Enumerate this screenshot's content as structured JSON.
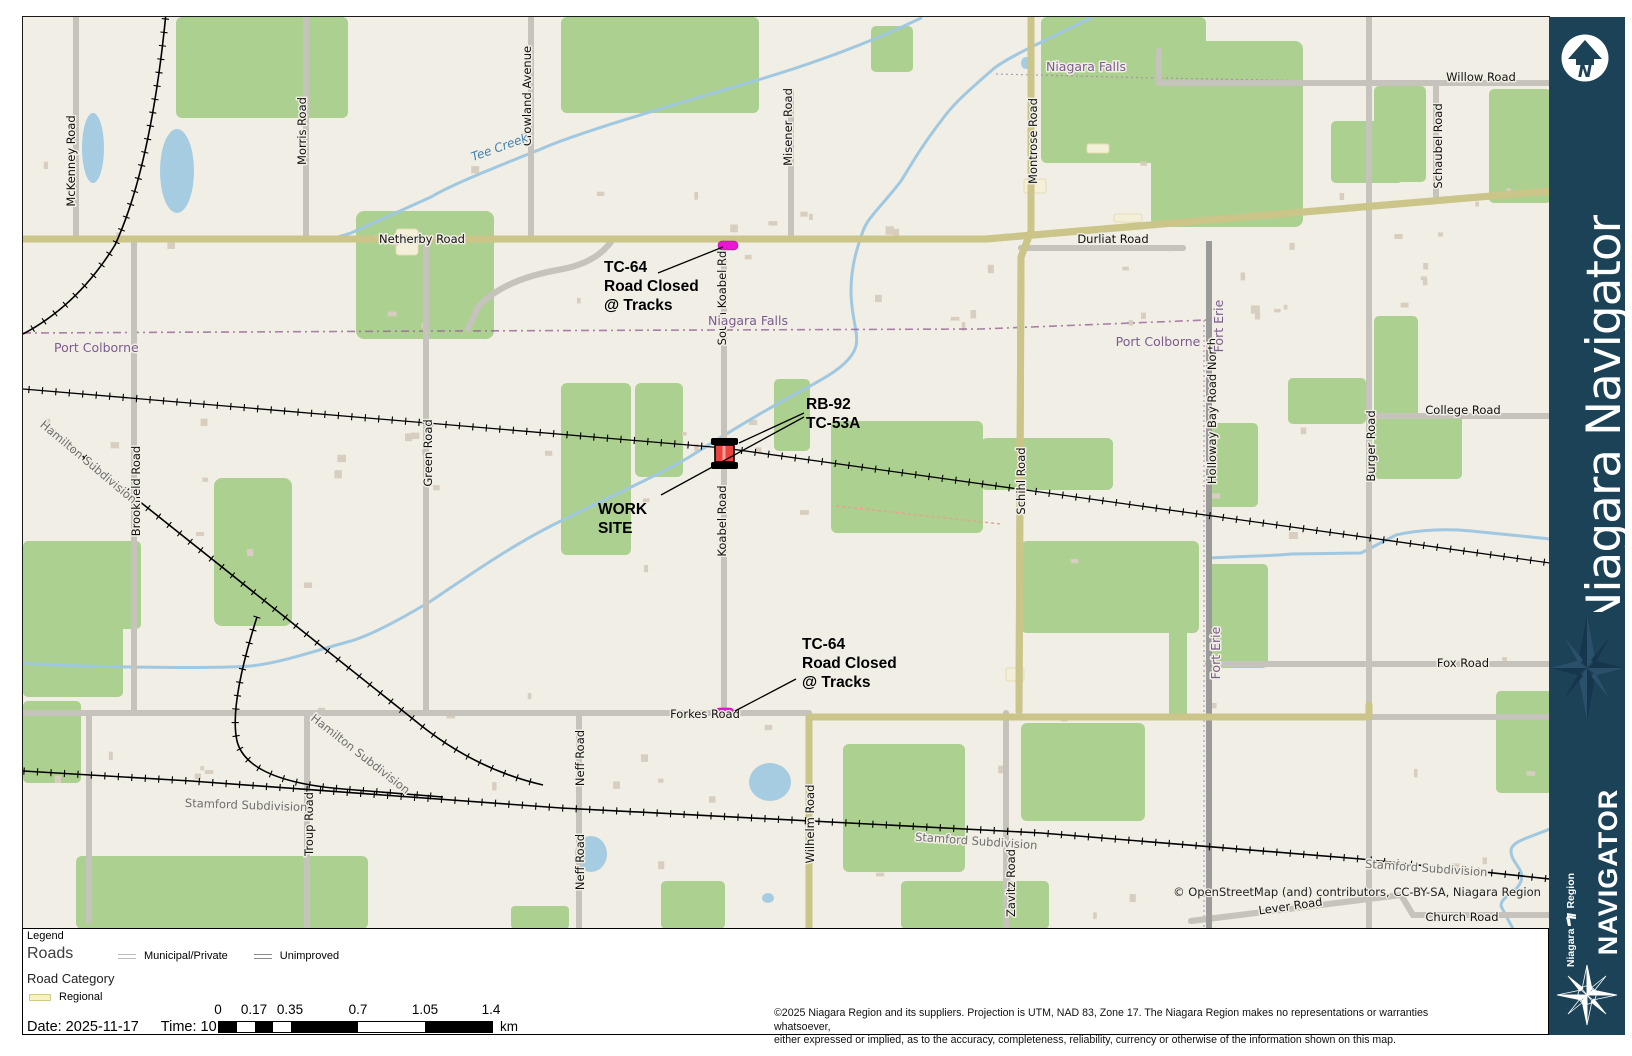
{
  "sidebar": {
    "brand": "Niagara Navigator",
    "navigator_label": "NAVIGATOR",
    "region_logo": {
      "line1": "Niagara",
      "line2": "Region"
    },
    "north_letter": "N"
  },
  "legend": {
    "title": "Legend",
    "roads_heading": "Roads",
    "road_category_heading": "Road Category",
    "road_items": [
      {
        "label": "Municipal/Private",
        "type": "municipal"
      },
      {
        "label": "Unimproved",
        "type": "unimproved"
      }
    ],
    "category_items": [
      {
        "label": "Regional",
        "type": "regional"
      }
    ],
    "date_label": "Date: 2025-11-17",
    "time_label": "Time: 10:06 AM"
  },
  "scalebar": {
    "ticks": [
      "0",
      "0.17",
      "0.35",
      "0.7",
      "1.05",
      "1.4"
    ],
    "unit": "km"
  },
  "footer": {
    "copyright_line1": "©2025 Niagara Region and its suppliers. Projection is UTM, NAD 83, Zone 17.  The Niagara Region makes no representations or warranties whatsoever,",
    "copyright_line2": "either expressed or implied, as to the accuracy, completeness, reliability, currency or otherwise of the information shown on this map."
  },
  "map": {
    "attribution": "© OpenStreetMap (and) contributors, CC-BY-SA, Niagara Region",
    "labels": [
      {
        "t": "McKenney Road",
        "x": 52,
        "y": 144,
        "r": -90,
        "c": ""
      },
      {
        "t": "Morris Road",
        "x": 283,
        "y": 114,
        "r": -90,
        "c": ""
      },
      {
        "t": "Crowland Avenue",
        "x": 508,
        "y": 79,
        "r": -90,
        "c": ""
      },
      {
        "t": "Misener Road",
        "x": 769,
        "y": 110,
        "r": -90,
        "c": ""
      },
      {
        "t": "South Koabel Rd",
        "x": 703,
        "y": 281,
        "r": -90,
        "c": ""
      },
      {
        "t": "Koabel Road",
        "x": 703,
        "y": 504,
        "r": -90,
        "c": ""
      },
      {
        "t": "Montrose Road",
        "x": 1014,
        "y": 124,
        "r": -90,
        "c": ""
      },
      {
        "t": "Schihl Road",
        "x": 1002,
        "y": 464,
        "r": -90,
        "c": ""
      },
      {
        "t": "Green Road",
        "x": 409,
        "y": 436,
        "r": -90,
        "c": ""
      },
      {
        "t": "Brookfield Road",
        "x": 117,
        "y": 474,
        "r": -90,
        "c": ""
      },
      {
        "t": "Burger Road",
        "x": 1352,
        "y": 429,
        "r": -90,
        "c": ""
      },
      {
        "t": "Holloway Bay Road North",
        "x": 1193,
        "y": 394,
        "r": -90,
        "c": ""
      },
      {
        "t": "Schaubel Road",
        "x": 1419,
        "y": 129,
        "r": -90,
        "c": ""
      },
      {
        "t": "Neff Road",
        "x": 561,
        "y": 741,
        "r": -90,
        "c": ""
      },
      {
        "t": "Neff Road",
        "x": 561,
        "y": 845,
        "r": -90,
        "c": ""
      },
      {
        "t": "Troup Road",
        "x": 290,
        "y": 807,
        "r": -90,
        "c": ""
      },
      {
        "t": "Wilhelm Road",
        "x": 791,
        "y": 807,
        "r": -90,
        "c": ""
      },
      {
        "t": "Zavitz Road",
        "x": 992,
        "y": 866,
        "r": -90,
        "c": ""
      },
      {
        "t": "Netherby Road",
        "x": 399,
        "y": 226,
        "r": 0,
        "c": ""
      },
      {
        "t": "Durliat Road",
        "x": 1090,
        "y": 226,
        "r": 0,
        "c": ""
      },
      {
        "t": "Willow Road",
        "x": 1458,
        "y": 64,
        "r": 0,
        "c": ""
      },
      {
        "t": "College Road",
        "x": 1440,
        "y": 397,
        "r": 0,
        "c": ""
      },
      {
        "t": "Fox Road",
        "x": 1440,
        "y": 650,
        "r": 0,
        "c": ""
      },
      {
        "t": "Forkes Road",
        "x": 682,
        "y": 701,
        "r": 0,
        "c": ""
      },
      {
        "t": "Lever Road",
        "x": 1268,
        "y": 893,
        "r": -8,
        "c": ""
      },
      {
        "t": "Church Road",
        "x": 1439,
        "y": 904,
        "r": 0,
        "c": ""
      },
      {
        "t": "Niagara Falls",
        "x": 1063,
        "y": 54,
        "r": 0,
        "c": "bnd"
      },
      {
        "t": "Niagara Falls",
        "x": 725,
        "y": 308,
        "r": 0,
        "c": "bnd"
      },
      {
        "t": "Port Colborne",
        "x": 31,
        "y": 335,
        "r": 0,
        "c": "bnd",
        "a": "start"
      },
      {
        "t": "Port Colborne",
        "x": 1135,
        "y": 329,
        "r": 0,
        "c": "bnd"
      },
      {
        "t": "Fort Erie",
        "x": 1200,
        "y": 309,
        "r": -90,
        "c": "bnd"
      },
      {
        "t": "Fort Erie",
        "x": 1197,
        "y": 636,
        "r": -90,
        "c": "bnd"
      },
      {
        "t": "Tee Creek",
        "x": 478,
        "y": 134,
        "r": -20,
        "c": "wtr"
      },
      {
        "t": "Hamilton Subdivision",
        "x": 63,
        "y": 448,
        "r": 40,
        "c": "sub"
      },
      {
        "t": "Hamilton Subdivision",
        "x": 335,
        "y": 740,
        "r": 38,
        "c": "sub"
      },
      {
        "t": "Stamford Subdivision",
        "x": 223,
        "y": 792,
        "r": 2,
        "c": "sub"
      },
      {
        "t": "Stamford Subdivision",
        "x": 953,
        "y": 828,
        "r": 4,
        "c": "sub"
      },
      {
        "t": "Stamford Subdivision",
        "x": 1403,
        "y": 855,
        "r": 4,
        "c": "sub"
      }
    ],
    "annotations": [
      {
        "id": "closure-north",
        "lines": [
          "TC-64",
          "Road Closed",
          "@ Tracks"
        ],
        "x": 581,
        "y": 255,
        "leaders": [
          [
            635,
            256,
            700,
            230
          ]
        ]
      },
      {
        "id": "worksite-ids",
        "lines": [
          "RB-92",
          "TC-53A"
        ],
        "x": 783,
        "y": 392,
        "leaders": [
          [
            781,
            396,
            716,
            426
          ],
          [
            781,
            400,
            638,
            478
          ]
        ]
      },
      {
        "id": "worksite",
        "lines": [
          "WORK",
          "SITE"
        ],
        "x": 575,
        "y": 497,
        "leaders": []
      },
      {
        "id": "closure-south",
        "lines": [
          "TC-64",
          "Road Closed",
          "@ Tracks"
        ],
        "x": 779,
        "y": 632,
        "leaders": [
          [
            773,
            662,
            712,
            694
          ]
        ]
      }
    ]
  }
}
